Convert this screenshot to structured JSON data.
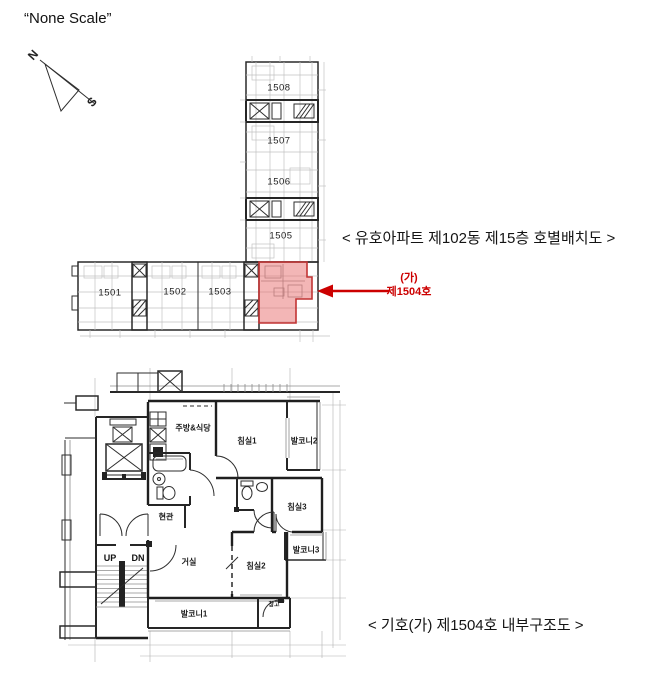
{
  "document": {
    "scale_note": "“None Scale”",
    "compass": {
      "north": "N",
      "south": "S"
    }
  },
  "site_plan": {
    "title": "< 유호아파트 제102동 제15층 호별배치도 >",
    "unit_labels": [
      "1508",
      "1507",
      "1506",
      "1505",
      "1501",
      "1502",
      "1503"
    ],
    "annotation": {
      "symbol": "(가)",
      "unit": "제1504호"
    },
    "colors": {
      "highlight_fill": "#ef9f9f",
      "highlight_border": "#c23434",
      "annotation_red": "#cc0000"
    }
  },
  "floor_plan": {
    "title": "< 기호(가) 제1504호 내부구조도 >",
    "room_labels": [
      "주방&식당",
      "침실1",
      "발코니2",
      "침실3",
      "발코니3",
      "거실",
      "침실2",
      "발코니1",
      "현관",
      "창고"
    ],
    "stair_labels": {
      "up": "UP",
      "dn": "DN"
    }
  }
}
